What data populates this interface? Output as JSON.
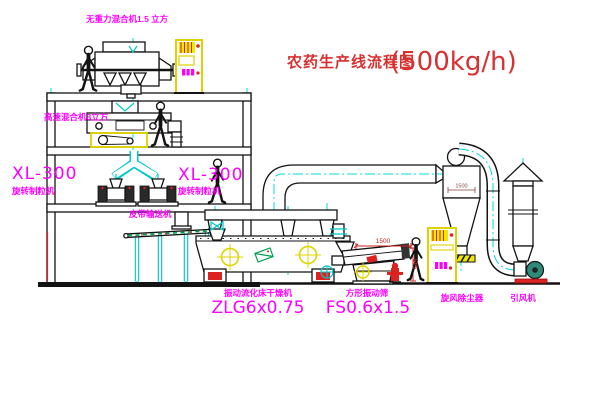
{
  "title": {
    "name": "农药生产线流程图",
    "capacity": "(500kg/h)"
  },
  "labels": {
    "top_mixer": "无重力混合机1.5 立方",
    "mid_mixer": "高速混合机3立方",
    "granulator_model_left": "XL-300",
    "granulator_name_left": "旋转制粒机",
    "granulator_model_right": "XL-300",
    "granulator_name_right": "旋转制粒机",
    "belt_conveyor": "皮带输送机",
    "dryer_name": "振动流化床干燥机",
    "dryer_model": "ZLG6x0.75",
    "screen_name": "方形振动筛",
    "screen_model": "FS0.6x1.5",
    "cyclone_name": "旋风除尘器",
    "fan_name": "引风机"
  },
  "dimensions": {
    "screen_length": "1500",
    "screen_height": "545",
    "cyclone_width": "1500"
  },
  "icons": {
    "person": "walking-person-icon",
    "control_cabinet": "yellow-control-cabinet-icon",
    "vibration_motor": "crosshair-motor-icon",
    "valve": "bowtie-valve-icon",
    "fan": "scroll-fan-icon"
  },
  "colors": {
    "title_red": "#d83030",
    "label_magenta": "#ff00ff",
    "centerline_cyan": "#00d8d8",
    "cad_yellow": "#ddd300",
    "cad_green": "#00a050",
    "fan_teal": "#2e8b7a",
    "accent_red": "#dd2222",
    "line_black": "#131313",
    "background": "#ffffff"
  }
}
